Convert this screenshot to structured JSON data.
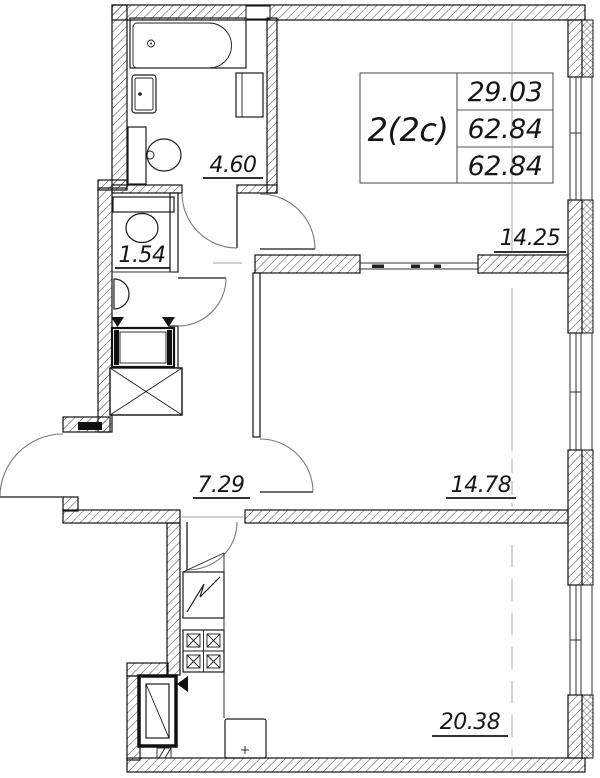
{
  "floor_plan": {
    "title_block": {
      "unit_type": "2(2c)",
      "values": [
        "29.03",
        "62.84",
        "62.84"
      ]
    },
    "room_areas": {
      "bathroom": "4.60",
      "wc": "1.54",
      "living_room": "14.25",
      "hall": "7.29",
      "bedroom": "14.78",
      "kitchen_living": "20.38"
    },
    "fixtures": [
      "bathtub",
      "washbasin",
      "tall-cabinet",
      "toilet",
      "wc-toilet",
      "wc-washbasin",
      "washing-machine",
      "wardrobe",
      "kitchen-sink",
      "stove",
      "refrigerator",
      "table"
    ],
    "colors": {
      "background": "#ffffff",
      "wall_line": "#111111",
      "hatch": "#333333",
      "door": "#7a7a7a",
      "centerline": "#a0a0a0"
    }
  }
}
